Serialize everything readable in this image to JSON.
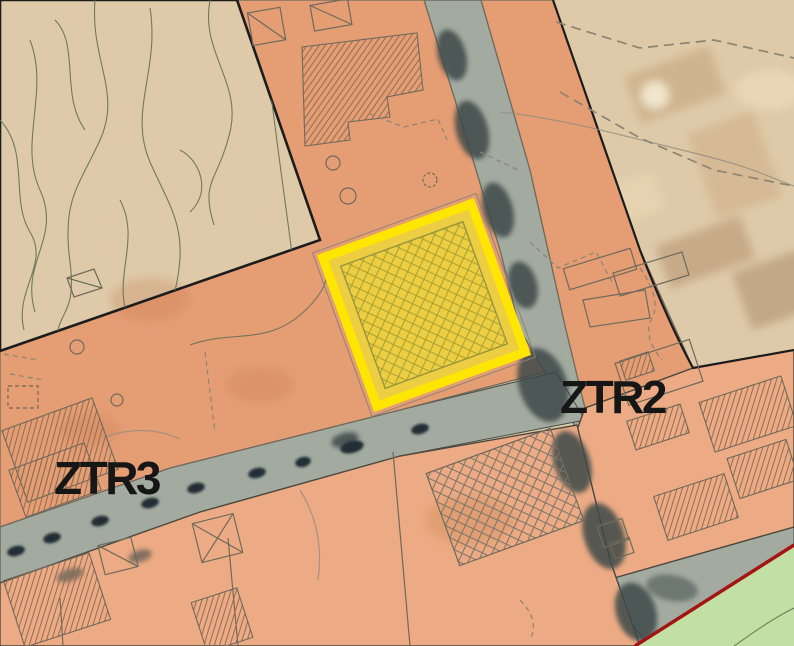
{
  "map": {
    "labels": {
      "ztr2": "ZTR2",
      "ztr3": "ZTR3"
    }
  },
  "colors": {
    "green_zone": "#b9d897",
    "green_zone_light": "#c2e0a4",
    "salmon_zone": "#e59d74",
    "salmon_zone_light": "#ecab84",
    "tan_zone": "#decaa9",
    "road": "#a3aba0",
    "road_shadow": "#3d4a48",
    "car_blob": "#232d35",
    "highlight_border": "#ffe600",
    "highlight_fill": "#eed938",
    "highlight_hatch": "#a3a02f",
    "hatch_line": "#8f6e54",
    "crosshatch_line": "#7c766a",
    "boundary_black": "#1c1c1c",
    "parcel_line": "#6e6a5c",
    "contour_line": "#647055",
    "dashed_line": "#8a8474",
    "red_boundary": "#a41414",
    "label_text": "#161616"
  }
}
